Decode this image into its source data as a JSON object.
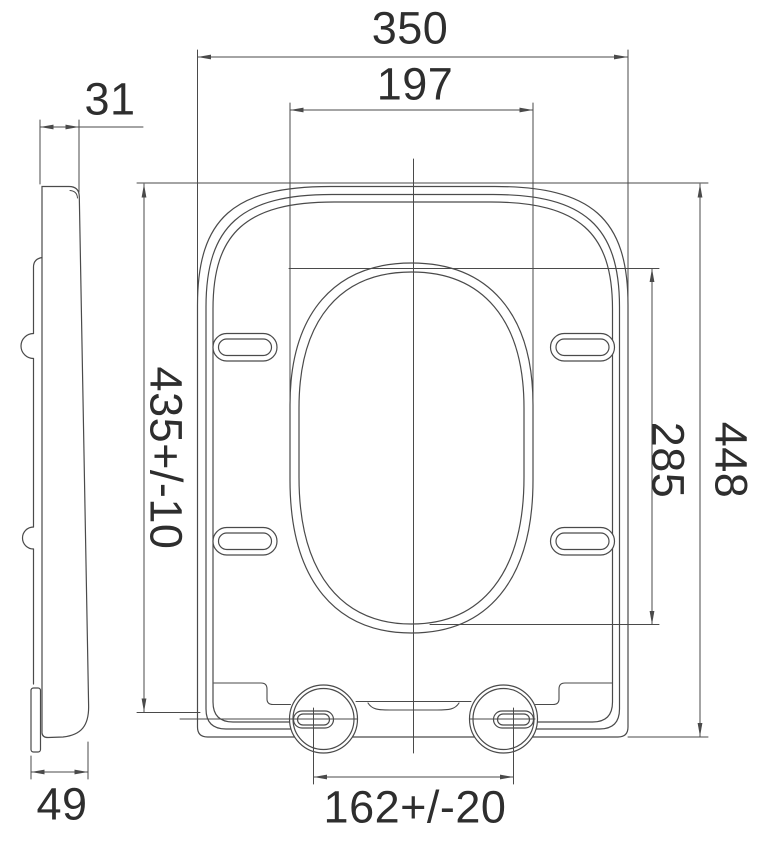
{
  "drawing": {
    "subject": "toilet-seat-technical-drawing",
    "unit": "mm",
    "views": {
      "side_view": "profile",
      "top_view": "plan"
    },
    "dims": {
      "overall_width": "350",
      "opening_width": "197",
      "side_top_thickness": "31",
      "seat_length_tol": "435+/-10",
      "overall_length": "448",
      "opening_length": "285",
      "hinge_spacing_tol": "162+/-20",
      "side_bottom_depth": "49"
    },
    "colors": {
      "line": "#4a4a4a",
      "text": "#2e2e2e",
      "background": "#ffffff"
    }
  }
}
